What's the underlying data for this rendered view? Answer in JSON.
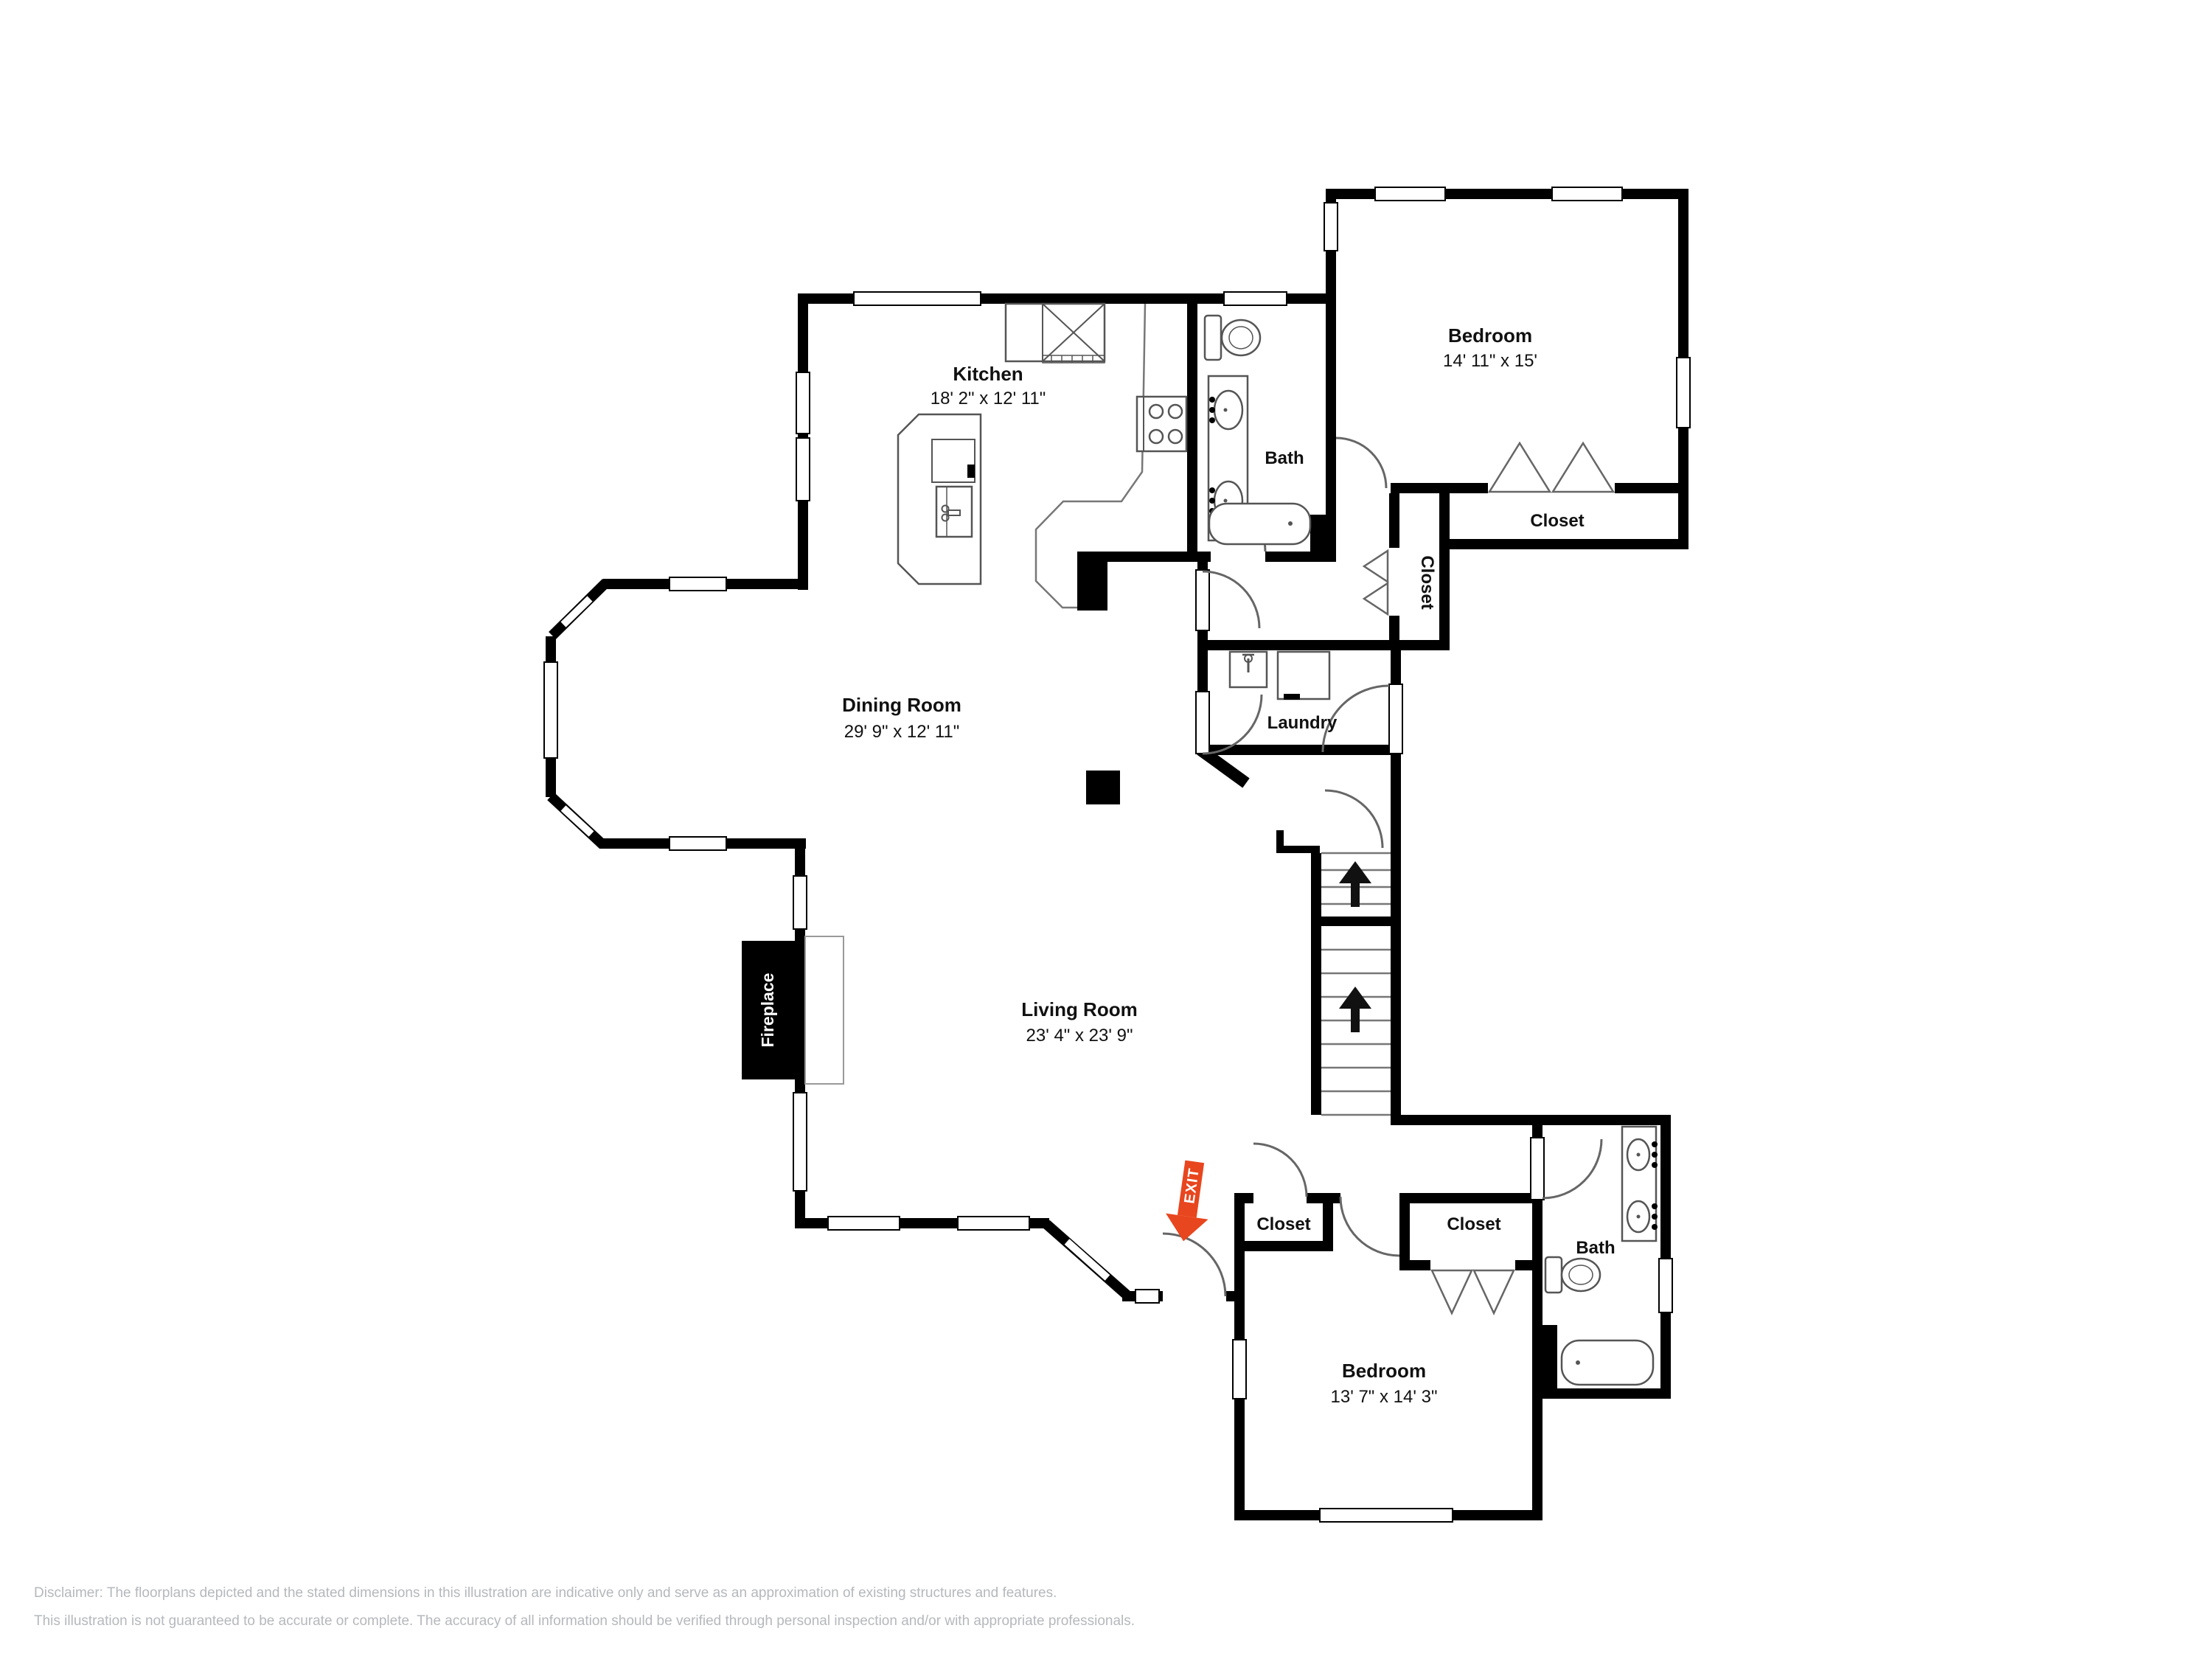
{
  "page": {
    "background": "#ffffff",
    "wall_color": "#000000",
    "accent_color": "#e8461e",
    "disclaimer_color": "#b5b8bc"
  },
  "rooms": {
    "kitchen": {
      "name": "Kitchen",
      "dims": "18' 2\" x 12' 11\""
    },
    "dining": {
      "name": "Dining Room",
      "dims": "29' 9\" x 12' 11\""
    },
    "living": {
      "name": "Living Room",
      "dims": "23' 4\" x 23' 9\""
    },
    "bedroom_upper": {
      "name": "Bedroom",
      "dims": "14' 11\" x 15'"
    },
    "bedroom_lower": {
      "name": "Bedroom",
      "dims": "13' 7\" x 14' 3\""
    },
    "bath_upper": {
      "name": "Bath"
    },
    "bath_lower": {
      "name": "Bath"
    },
    "laundry": {
      "name": "Laundry"
    },
    "closet_bedroom_upper": {
      "name": "Closet"
    },
    "closet_hall": {
      "name": "Closet"
    },
    "closet_lower_left": {
      "name": "Closet"
    },
    "closet_lower_right": {
      "name": "Closet"
    },
    "fireplace": {
      "name": "Fireplace"
    }
  },
  "exit": {
    "label": "EXIT"
  },
  "disclaimer": {
    "line1": "Disclaimer: The floorplans depicted and the stated dimensions in this illustration are indicative only and serve as an approximation of existing structures and features.",
    "line2": "This illustration is not guaranteed to be accurate or complete. The accuracy of all information should be verified through personal inspection and/or with appropriate professionals."
  }
}
